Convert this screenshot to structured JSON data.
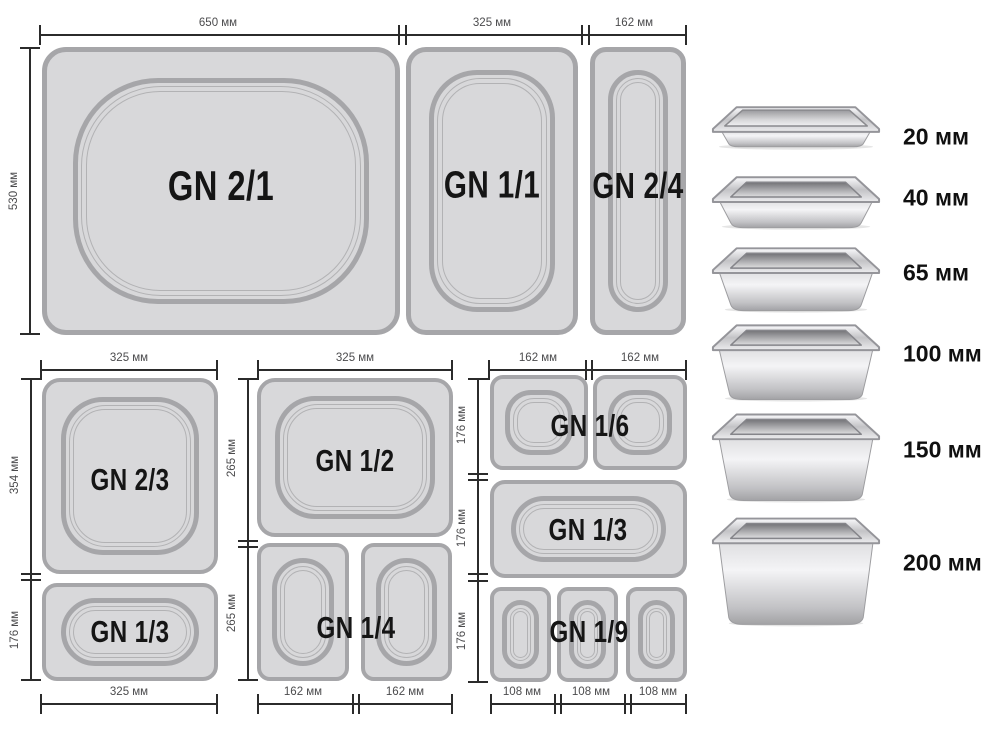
{
  "colors": {
    "background": "#ffffff",
    "pan_fill": "#d8d8da",
    "pan_border": "#a6a6a9",
    "dimension_line": "#2b2b2b",
    "dimension_text": "#4b4b4d",
    "gn_label_text": "#151515"
  },
  "diagram": {
    "top_row": {
      "width_650": "650 мм",
      "width_325": "325 мм",
      "width_162": "162 мм",
      "height_530": "530 мм",
      "gn_2_1": "GN 2/1",
      "gn_1_1": "GN 1/1",
      "gn_2_4": "GN 2/4"
    },
    "left_column": {
      "width_top": "325 мм",
      "height_354": "354 мм",
      "height_176": "176 мм",
      "width_bottom": "325 мм",
      "gn_2_3": "GN 2/3",
      "gn_1_3": "GN 1/3"
    },
    "middle_column": {
      "width_top": "325 мм",
      "height_265_upper": "265 мм",
      "height_265_lower": "265 мм",
      "width_162_left": "162 мм",
      "width_162_right": "162 мм",
      "gn_1_2": "GN 1/2",
      "gn_1_4": "GN 1/4"
    },
    "right_column": {
      "width_162_left": "162 мм",
      "width_162_right": "162 мм",
      "height_176_top": "176 мм",
      "height_176_middle": "176 мм",
      "height_176_bottom": "176 мм",
      "width_108_a": "108 мм",
      "width_108_b": "108 мм",
      "width_108_c": "108 мм",
      "gn_1_6": "GN 1/6",
      "gn_1_3": "GN 1/3",
      "gn_1_9": "GN 1/9"
    }
  },
  "depth_chart": {
    "items": [
      {
        "label": "20 мм"
      },
      {
        "label": "40 мм"
      },
      {
        "label": "65 мм"
      },
      {
        "label": "100 мм"
      },
      {
        "label": "150 мм"
      },
      {
        "label": "200 мм"
      }
    ]
  }
}
